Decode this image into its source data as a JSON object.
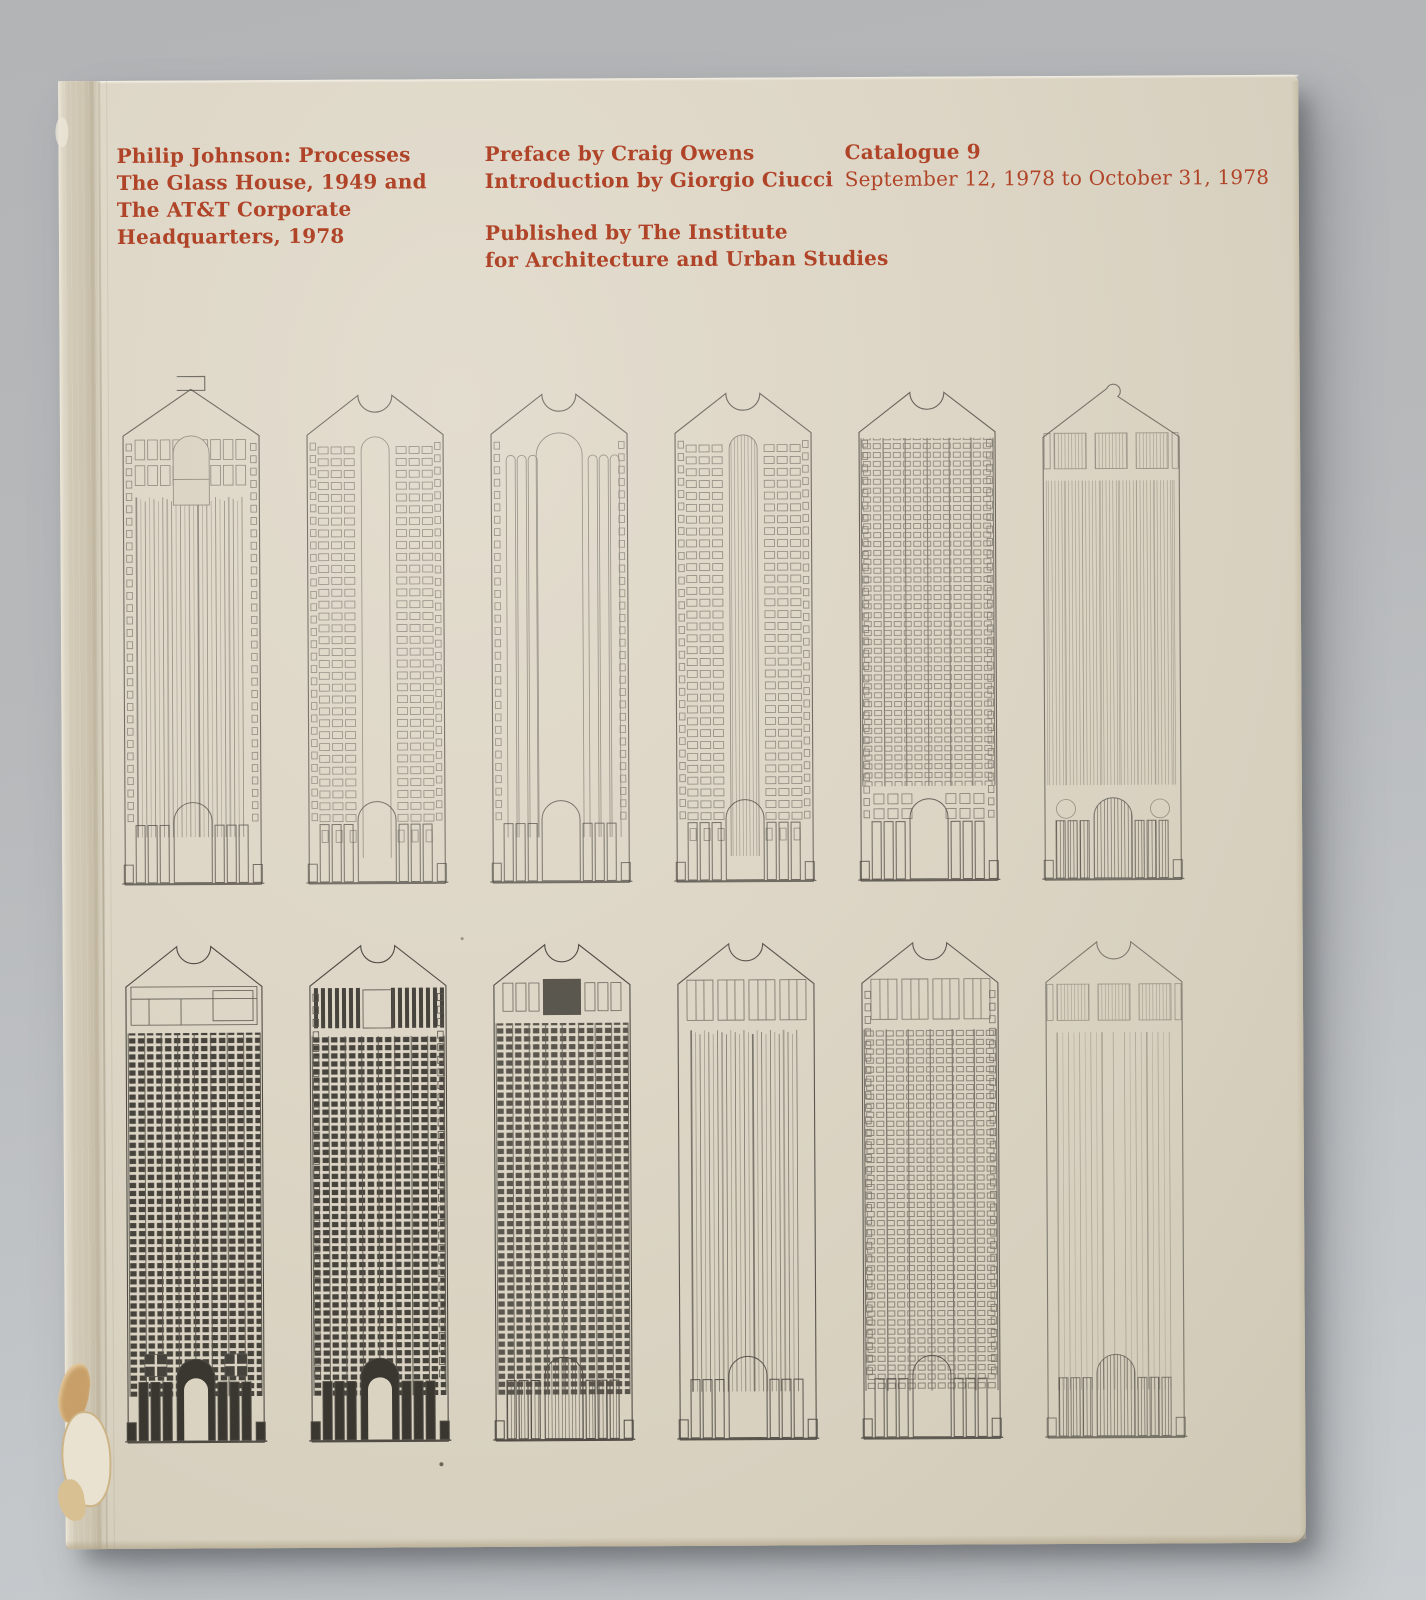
{
  "book": {
    "accent_color": "#b04428",
    "cover_color": "#ddd6c6",
    "title_lines": [
      "Philip Johnson: Processes",
      "The Glass House, 1949 and",
      "The AT&T Corporate",
      "Headquarters, 1978"
    ],
    "credit_lines": [
      "Preface by Craig Owens",
      "Introduction by Giorgio Ciucci"
    ],
    "publisher_lines": [
      "Published by The Institute",
      "for Architecture and Urban Studies"
    ],
    "catalogue_title": "Catalogue 9",
    "catalogue_dates": "September 12, 1978 to October 31, 1978",
    "drawings": {
      "description": "Twelve pencil elevation studies of the AT&T Corporate Headquarters tower with broken-pediment tops, arranged in two rows of six",
      "line_color": "#4f4b44",
      "ink_dark": "#3a3731",
      "paper_color": "#dad3c2",
      "towers": [
        {
          "id": "study-1",
          "pediment": "block",
          "facade": "stripes",
          "topBand": "windows",
          "topArch": true,
          "edgeSquares": true,
          "shaftFill": "blank",
          "ornament": "none",
          "ink": 0.55,
          "base": "line"
        },
        {
          "id": "study-2",
          "pediment": "notch",
          "facade": "grid-flank",
          "topBand": "none",
          "topArch": false,
          "edgeSquares": true,
          "shaftFill": "blank",
          "ornament": "none",
          "ink": 0.5,
          "base": "line"
        },
        {
          "id": "study-3",
          "pediment": "notch",
          "facade": "pipes",
          "topBand": "none",
          "topArch": false,
          "edgeSquares": true,
          "shaftFill": "blank",
          "ornament": "none",
          "ink": 0.5,
          "base": "line"
        },
        {
          "id": "study-4",
          "pediment": "notch",
          "facade": "grid-flank",
          "topBand": "none",
          "topArch": false,
          "edgeSquares": true,
          "shaftFill": "hatch",
          "ornament": "none",
          "ink": 0.55,
          "base": "line"
        },
        {
          "id": "study-5",
          "pediment": "notch",
          "facade": "grid",
          "topBand": "none",
          "topArch": false,
          "edgeSquares": true,
          "shaftFill": "blank",
          "ornament": "squares",
          "ink": 0.62,
          "base": "line"
        },
        {
          "id": "study-6",
          "pediment": "curl",
          "facade": "hatch",
          "topBand": "panels",
          "topArch": false,
          "edgeSquares": false,
          "shaftFill": "blank",
          "ornament": "circles",
          "ink": 0.5,
          "base": "shaded"
        },
        {
          "id": "study-7",
          "pediment": "notch",
          "facade": "grid-dark",
          "topBand": "ledge",
          "topArch": false,
          "edgeSquares": false,
          "shaftFill": "blank",
          "ornament": "cross",
          "ink": 0.92,
          "base": "dark"
        },
        {
          "id": "study-8",
          "pediment": "notch",
          "facade": "grid-dark",
          "topBand": "slats",
          "topArch": false,
          "edgeSquares": true,
          "shaftFill": "blank",
          "ornament": "none",
          "ink": 0.92,
          "base": "dark"
        },
        {
          "id": "study-9",
          "pediment": "notch",
          "facade": "grid-dark",
          "topBand": "centerblock",
          "topArch": false,
          "edgeSquares": false,
          "shaftFill": "blank",
          "ornament": "none",
          "ink": 0.8,
          "base": "shaded"
        },
        {
          "id": "study-10",
          "pediment": "notch",
          "facade": "stripes",
          "topBand": "openings",
          "topArch": false,
          "edgeSquares": false,
          "shaftFill": "blank",
          "ornament": "none",
          "ink": 0.72,
          "base": "line"
        },
        {
          "id": "study-11",
          "pediment": "notch",
          "facade": "grid",
          "topBand": "openings",
          "topArch": false,
          "edgeSquares": true,
          "shaftFill": "blank",
          "ornament": "none",
          "ink": 0.68,
          "base": "line"
        },
        {
          "id": "study-12",
          "pediment": "notch",
          "facade": "stripes-light",
          "topBand": "panels",
          "topArch": false,
          "edgeSquares": false,
          "shaftFill": "blank",
          "ornament": "none",
          "ink": 0.45,
          "base": "shaded"
        }
      ]
    }
  }
}
